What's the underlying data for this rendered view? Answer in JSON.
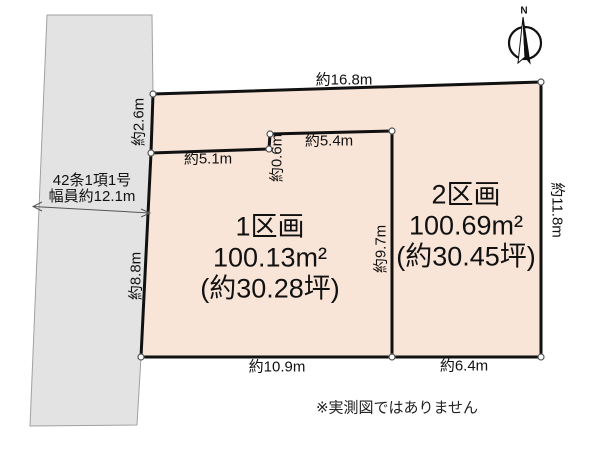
{
  "compass": {
    "north_label": "N"
  },
  "road": {
    "regulation": "42条1項1号",
    "width_label": "幅員約12.1m"
  },
  "parcels": [
    {
      "name": "1区画",
      "area_sqm": "100.13m²",
      "area_tsubo": "(約30.28坪)"
    },
    {
      "name": "2区画",
      "area_sqm": "100.69m²",
      "area_tsubo": "(約30.45坪)"
    }
  ],
  "dimensions": {
    "top_edge": "約16.8m",
    "left_upper_edge": "約2.6m",
    "inner_left_segment": "約5.1m",
    "inner_step": "約0.6m",
    "inner_right_segment": "約5.4m",
    "divider": "約9.7m",
    "right_edge": "約11.8m",
    "left_lower_edge": "約8.8m",
    "bottom_left_edge": "約10.9m",
    "bottom_right_edge": "約6.4m"
  },
  "note": "※実測図ではありません",
  "colors": {
    "parcel_fill": "#f8e5d8",
    "road_fill": "#e3e3e4",
    "boundary": "#111111"
  }
}
